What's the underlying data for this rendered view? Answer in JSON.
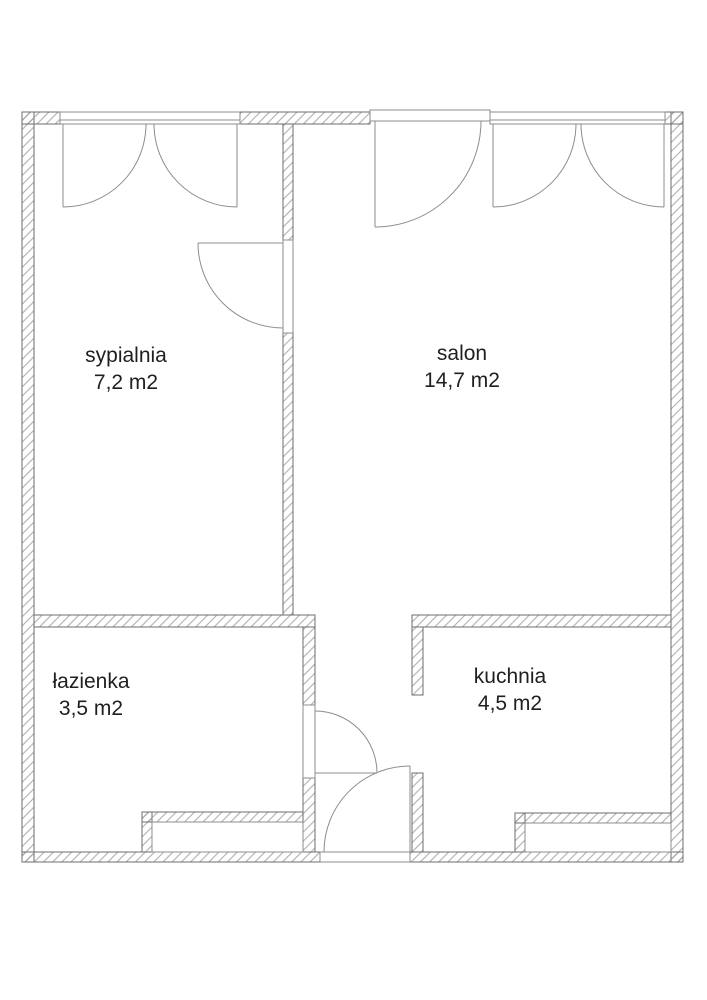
{
  "plan_type": "apartment-floor-plan",
  "rooms": [
    {
      "id": "sypialnia",
      "name": "sypialnia",
      "area": "7,2 m2"
    },
    {
      "id": "salon",
      "name": "salon",
      "area": "14,7 m2"
    },
    {
      "id": "lazienka",
      "name": "łazienka",
      "area": "3,5 m2"
    },
    {
      "id": "kuchnia",
      "name": "kuchnia",
      "area": "4,5 m2"
    }
  ],
  "colors": {
    "wall-outline": "#6e6e6e",
    "hatch": "#9e9e9e",
    "fixture": "#8d8d8d",
    "text": "#1f1f1f",
    "background": "#ffffff"
  }
}
